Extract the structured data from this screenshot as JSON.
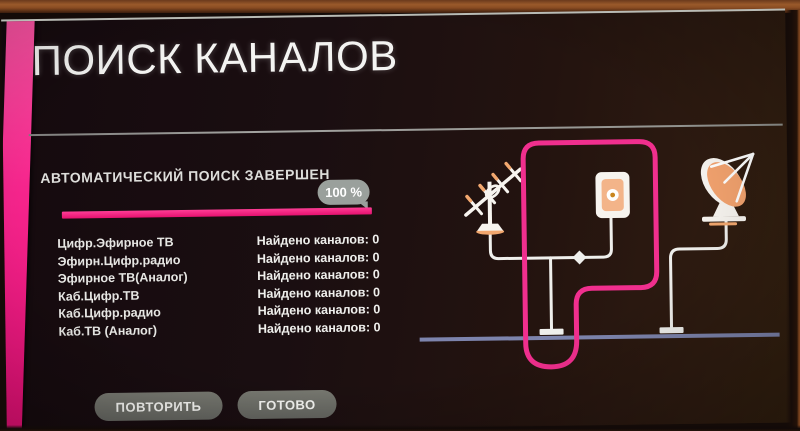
{
  "screen": {
    "title": "ПОИСК КАНАЛОВ",
    "status": {
      "label": "АВТОМАТИЧЕСКИЙ ПОИСК ЗАВЕРШЕН",
      "progress_percent": "100 %",
      "progress_value": 100
    },
    "results": {
      "rows": [
        {
          "label": "Цифр.Эфирное ТВ",
          "value": "Найдено каналов: 0"
        },
        {
          "label": "Эфирн.Цифр.радио",
          "value": "Найдено каналов: 0"
        },
        {
          "label": "Эфирное ТВ(Аналог)",
          "value": "Найдено каналов: 0"
        },
        {
          "label": "Каб.Цифр.ТВ",
          "value": "Найдено каналов: 0"
        },
        {
          "label": "Каб.Цифр.радио",
          "value": "Найдено каналов: 0"
        },
        {
          "label": "Каб.ТВ (Аналог)",
          "value": "Найдено каналов: 0"
        }
      ]
    },
    "buttons": {
      "repeat": "ПОВТОРИТЬ",
      "done": "ГОТОВО"
    },
    "illustration": {
      "icons": [
        "antenna-icon",
        "wall-socket-icon",
        "satellite-dish-icon",
        "cable-junction-node"
      ]
    },
    "colors": {
      "accent_pink": "#f02f8e",
      "stripe_pink": "#f5258c",
      "progress_pink": "#e5116f",
      "bubble_gray": "#9aa09c",
      "button_gray": "#6c6d66",
      "baseboard_blue": "#7d84ad",
      "icon_orange": "#f2a76e",
      "cable_white": "#efefec"
    }
  }
}
